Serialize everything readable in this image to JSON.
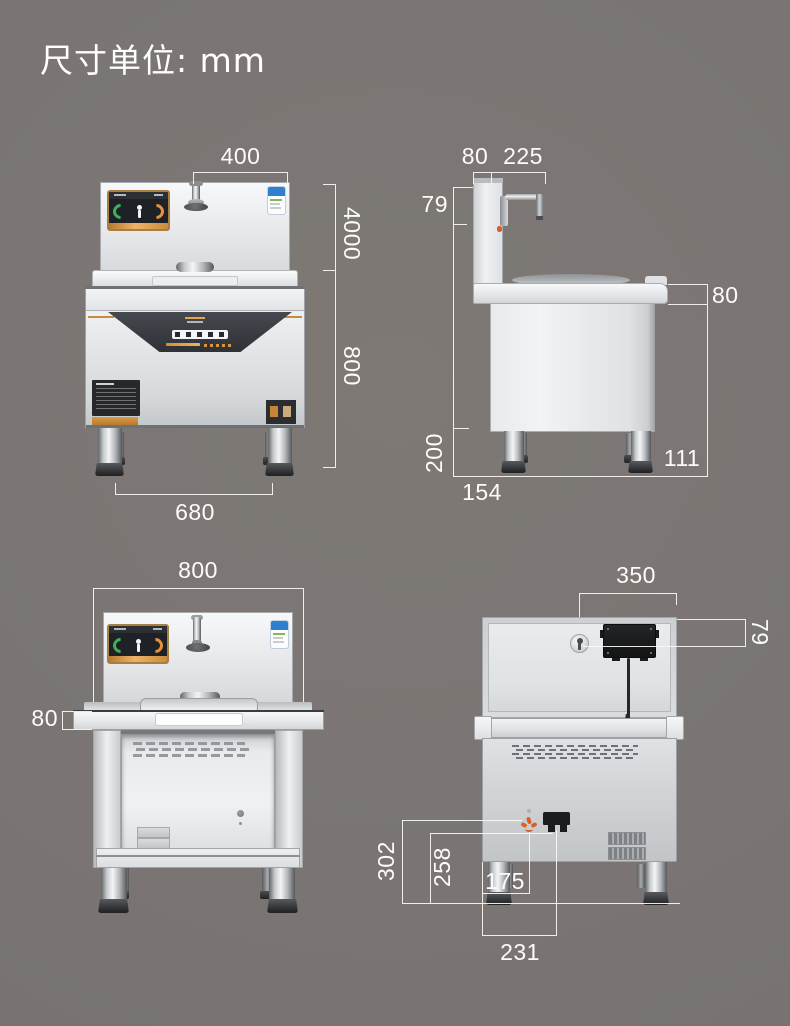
{
  "title": "尺寸单位: mm",
  "unit": "mm",
  "colors": {
    "background": "#7a7572",
    "dimension_line": "#f7f4f1",
    "dimension_text": "#ffffff",
    "steel_light": "#f2f3f5",
    "steel_shadow": "#9fa3a7",
    "accent_orange": "#cf8c3e",
    "display_green": "#41b054",
    "display_orange": "#e8903c",
    "energy_label_blue": "#2f7fd0",
    "junction_box_black": "#1a1b1d",
    "drain_icon_orange": "#d95f26"
  },
  "views": {
    "front_upper": {
      "dims": {
        "faucet_span": "400",
        "upper_height": "4000",
        "body_height": "800",
        "leg_span": "680"
      }
    },
    "side": {
      "dims": {
        "splash_depth": "80",
        "faucet_reach": "225",
        "faucet_drop": "79",
        "counter_thickness": "80",
        "leg_height": "200",
        "front_inset": "154",
        "rear_inset": "111"
      }
    },
    "front_lower": {
      "dims": {
        "overall_width": "800",
        "counter_thickness": "80"
      }
    },
    "rear": {
      "dims": {
        "box_span": "350",
        "inlet_drop": "79",
        "drain_height": "302",
        "plug_height": "258",
        "drain_offset": "175",
        "plug_offset": "231"
      }
    }
  }
}
